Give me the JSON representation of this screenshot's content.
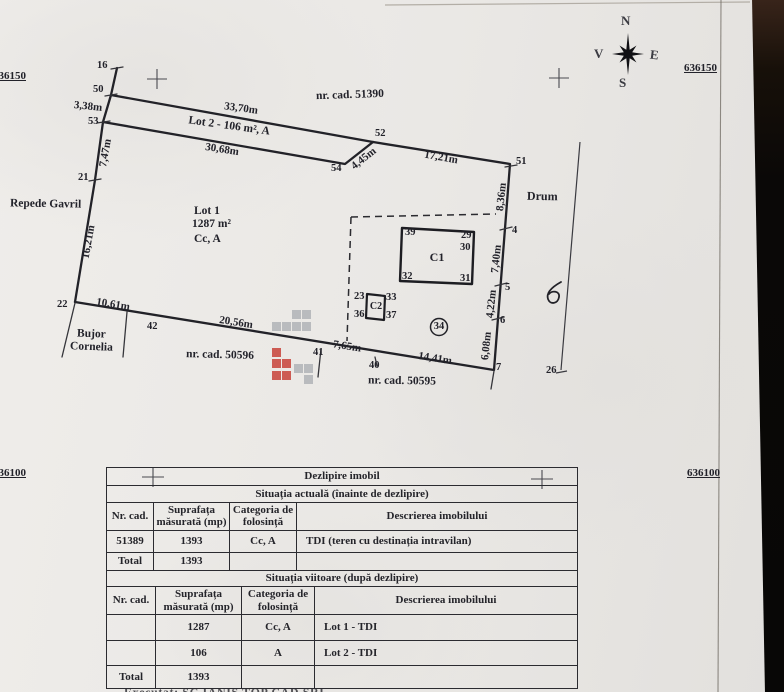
{
  "colors": {
    "paper": "#eae8e5",
    "ink": "#22222a",
    "scan_edge": "#0b0908",
    "watermark_gray": "#8f959c",
    "watermark_red": "#c6372e"
  },
  "grid": {
    "top_left": "636150",
    "top_right": "636150",
    "bottom_left": "636100",
    "bottom_right": "636100"
  },
  "compass": {
    "n": "N",
    "e": "E",
    "s": "S",
    "v": "V"
  },
  "plot": {
    "cad_top": "nr. cad. 51390",
    "cad_bottom_left": "nr. cad. 50596",
    "cad_bottom": "nr. cad. 50595",
    "neighbor_left": "Repede Gavril",
    "neighbor_bottom_line1": "Bujor",
    "neighbor_bottom_line2": "Cornelia",
    "road": "Drum",
    "lot1_name": "Lot 1",
    "lot1_area": "1287 m²",
    "lot1_cat": "Cc, A",
    "lot2_label": "Lot 2 - 106 m², A",
    "points": {
      "p4": "4",
      "p5": "5",
      "p6": "6",
      "p7": "7",
      "p16": "16",
      "p21": "21",
      "p22": "22",
      "p26": "26",
      "p40": "40",
      "p41": "41",
      "p42": "42",
      "p50": "50",
      "p51": "51",
      "p52": "52",
      "p53": "53",
      "p54": "54"
    },
    "dims": {
      "d33_70": "33,70m",
      "d30_68": "30,68m",
      "d3_38": "3,38m",
      "d7_47": "7,47m",
      "d16_21": "16,21m",
      "d10_61": "10,61m",
      "d20_56": "20,56m",
      "d7_65": "7,65m",
      "d14_41": "14,41m",
      "d4_45": "4,45m",
      "d17_21": "17,21m",
      "d8_36": "8,36m",
      "d7_40": "7,40m",
      "d4_22": "4,22m",
      "d6_08": "6,08m"
    },
    "c1": {
      "label": "C1",
      "p29": "29",
      "p30": "30",
      "p31": "31",
      "p32": "32",
      "p39": "39"
    },
    "c2": {
      "label": "C2",
      "p23": "23",
      "p33": "33",
      "p36": "36",
      "p37": "37"
    },
    "c34": "34"
  },
  "table": {
    "title": "Dezlipire imobil",
    "current": {
      "section": "Situația actuală (înainte de dezlipire)",
      "headers": [
        "Nr. cad.",
        "Suprafața măsurată (mp)",
        "Categoria de folosință",
        "Descrierea imobilului"
      ],
      "rows": [
        [
          "51389",
          "1393",
          "Cc, A",
          "TDI (teren cu destinația intravilan)"
        ],
        [
          "Total",
          "1393",
          "",
          ""
        ]
      ]
    },
    "future": {
      "section": "Situația viitoare (după dezlipire)",
      "headers": [
        "Nr. cad.",
        "Suprafața măsurată (mp)",
        "Categoria de folosință",
        "Descrierea imobilului"
      ],
      "rows": [
        [
          "",
          "1287",
          "Cc, A",
          "Lot 1 - TDI"
        ],
        [
          "",
          "106",
          "A",
          "Lot 2 - TDI"
        ],
        [
          "Total",
          "1393",
          "",
          ""
        ]
      ]
    },
    "footer": "Executat: SC IANIS TOP CAD SRL"
  }
}
